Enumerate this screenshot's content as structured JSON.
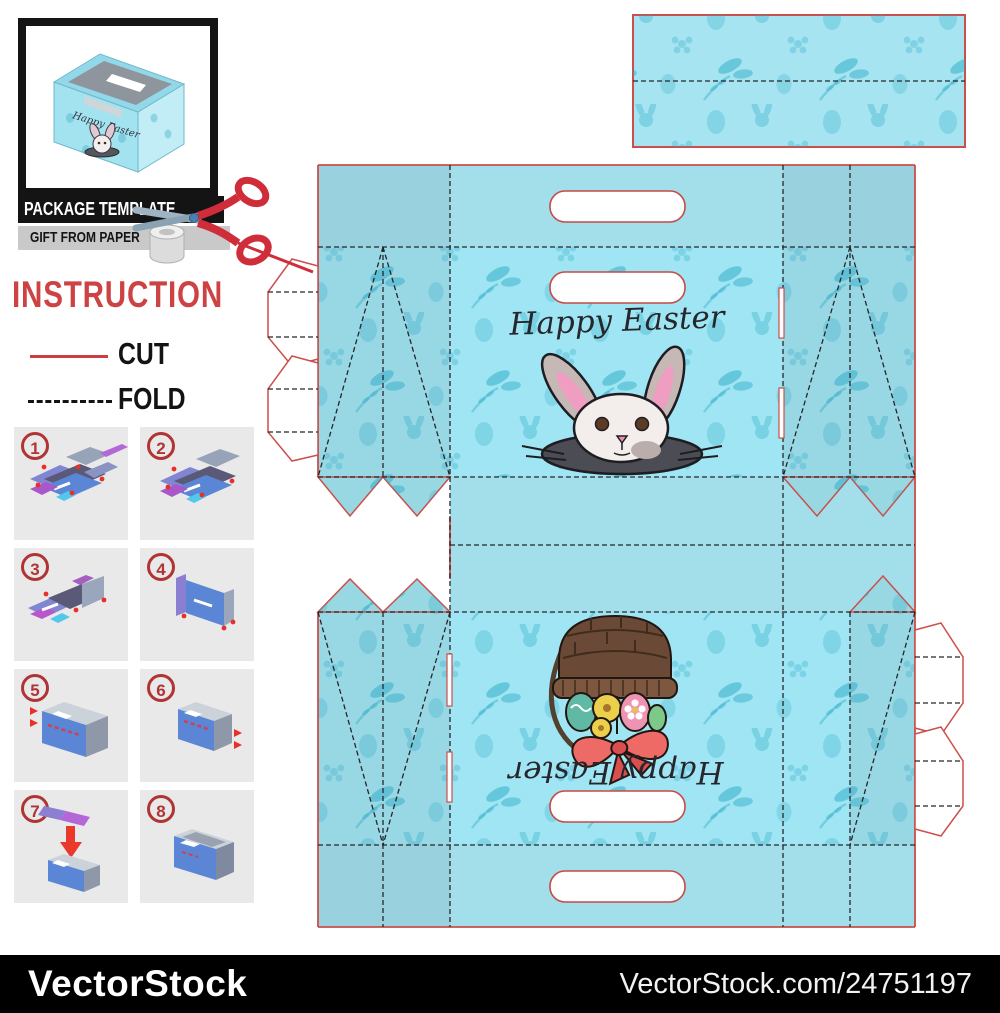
{
  "header": {
    "banner1": "PACKAGE TEMPLATE",
    "banner2": "GIFT FROM PAPER"
  },
  "preview": {
    "front_text": "Happy Easter"
  },
  "instruction": {
    "title": "INSTRUCTION",
    "legend": [
      {
        "label": "CUT",
        "style": "solid",
        "color": "#c94040"
      },
      {
        "label": "FOLD",
        "style": "dashed",
        "color": "#131313"
      }
    ],
    "steps": [
      {
        "number": "1"
      },
      {
        "number": "2"
      },
      {
        "number": "3"
      },
      {
        "number": "4"
      },
      {
        "number": "5"
      },
      {
        "number": "6"
      },
      {
        "number": "7"
      },
      {
        "number": "8"
      }
    ]
  },
  "template": {
    "front_text": "Happy Easter",
    "back_text": "Happy Easter",
    "colors": {
      "paper": "#a0e5f3",
      "paper_plain": "#a3dfeb",
      "pattern_motif": "#2aa9c6",
      "cut_line": "#cb4f4b",
      "fold_line": "#26262a",
      "gusset_shade": "rgba(105,135,150,0.15)"
    }
  },
  "watermark": {
    "brand": "VectorStock",
    "ref": "VectorStock.com/24751197",
    "bg": "#000000"
  }
}
